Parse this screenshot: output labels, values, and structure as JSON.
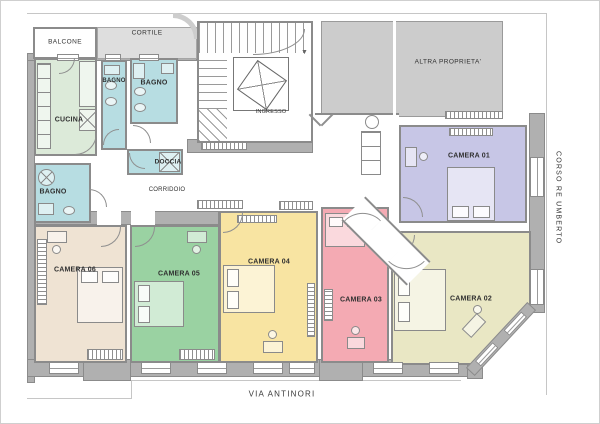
{
  "plan": {
    "streets": {
      "bottom": "VIA ANTINORI",
      "right": "CORSO RE UMBERTO"
    },
    "areas": {
      "balcone": "BALCONE",
      "cortile": "CORTILE",
      "altra_proprieta": "ALTRA PROPRIETA'",
      "ingresso": "INGRESSO"
    },
    "rooms": [
      {
        "id": "cucina",
        "label": "CUCINA",
        "color": "#dcead9"
      },
      {
        "id": "bagno-1",
        "label": "BAGNO",
        "color": "#b7dde2"
      },
      {
        "id": "bagno-2",
        "label": "BAGNO",
        "color": "#b7dde2"
      },
      {
        "id": "doccia",
        "label": "DOCCIA",
        "color": "#b7dde2"
      },
      {
        "id": "bagno-3",
        "label": "BAGNO",
        "color": "#b7dde2"
      },
      {
        "id": "corridoio",
        "label": "CORRIDOIO",
        "color": "#ffffff"
      },
      {
        "id": "camera-01",
        "label": "CAMERA 01",
        "color": "#c7c6e6"
      },
      {
        "id": "camera-02",
        "label": "CAMERA 02",
        "color": "#e9e7c4"
      },
      {
        "id": "camera-03",
        "label": "CAMERA 03",
        "color": "#f4aab3"
      },
      {
        "id": "camera-04",
        "label": "CAMERA 04",
        "color": "#f8e4a2"
      },
      {
        "id": "camera-05",
        "label": "CAMERA 05",
        "color": "#9ad2a2"
      },
      {
        "id": "camera-06",
        "label": "CAMERA 06",
        "color": "#efe3d3"
      }
    ],
    "colors": {
      "wall": "#b0b0b0",
      "wall_line": "#8b8b8b",
      "courtyard": "#dedede",
      "other_property": "#cccccc",
      "boundary": "#c6c6c6",
      "text": "#303030"
    }
  }
}
